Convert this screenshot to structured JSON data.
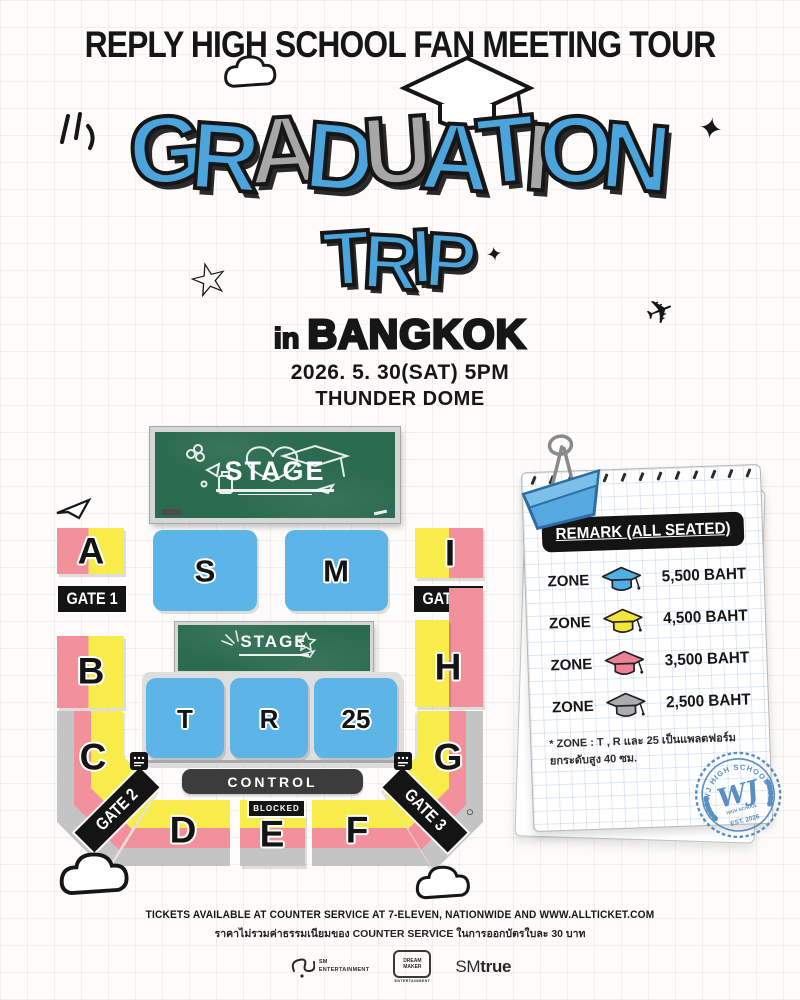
{
  "poster_title": "REPLY HIGH SCHOOL FAN MEETING TOUR",
  "hero": {
    "letters": [
      {
        "ch": "G",
        "color": "blue"
      },
      {
        "ch": "R",
        "color": "blue"
      },
      {
        "ch": "A",
        "color": "gray"
      },
      {
        "ch": "D",
        "color": "blue"
      },
      {
        "ch": "U",
        "color": "gray"
      },
      {
        "ch": "A",
        "color": "blue"
      },
      {
        "ch": "T",
        "color": "blue"
      },
      {
        "ch": "I",
        "color": "gray"
      },
      {
        "ch": "O",
        "color": "blue"
      },
      {
        "ch": "N",
        "color": "blue"
      }
    ],
    "line2": "TRIP",
    "location_prefix": "in",
    "location": "BANGKOK",
    "date_line": "2026. 5. 30(SAT) 5PM",
    "venue_line": "THUNDER DOME",
    "colors": {
      "blue": "#4BA5DC",
      "gray": "#A7A7A7"
    }
  },
  "map": {
    "stage_main_label": "STAGE",
    "stage_second_label": "STAGE",
    "zones": {
      "a": "A",
      "b": "B",
      "c": "C",
      "d": "D",
      "e": "E",
      "f": "F",
      "g": "G",
      "h": "H",
      "i": "I",
      "s": "S",
      "m": "M",
      "t": "T",
      "r": "R",
      "z25": "25"
    },
    "gates": {
      "g1": "GATE 1",
      "g2": "GATE 2",
      "g3": "GATE 3",
      "g4": "GATE 4"
    },
    "control_label": "CONTROL",
    "blocked_label": "BLOCKED"
  },
  "remark": {
    "header": "REMARK (ALL SEATED)",
    "rows": [
      {
        "label": "ZONE",
        "cap_color": "#4FAEE3",
        "price": "5,500 BAHT"
      },
      {
        "label": "ZONE",
        "cap_color": "#F2E63A",
        "price": "4,500 BAHT"
      },
      {
        "label": "ZONE",
        "cap_color": "#EE8193",
        "price": "3,500 BAHT"
      },
      {
        "label": "ZONE",
        "cap_color": "#ACACAC",
        "price": "2,500 BAHT"
      }
    ],
    "note_line1": "* ZONE : T , R และ 25 เป็นแพลตฟอร์ม",
    "note_line2": "ยกระดับสูง 40 ซม.",
    "badge": {
      "arc_text": "WJ HIGH SCHOOL",
      "monogram": "WJ",
      "sub_text": "HIGH SCHOOL",
      "est_text": "EST. 2026"
    }
  },
  "footer": {
    "tickets_line": "TICKETS AVAILABLE AT COUNTER SERVICE AT 7-ELEVEN, NATIONWIDE AND WWW.ALLTICKET.COM",
    "fee_line": "ราคาไม่รวมค่าธรรมเนียมของ COUNTER SERVICE ในการออกบัตรใบละ 30 บาท",
    "logos": {
      "sm_line1": "SM",
      "sm_line2": "ENTERTAINMENT",
      "dm_line1": "DREAM",
      "dm_line2": "MAKER",
      "dm_sub": "ENTERTAINMENT",
      "smtrue_sm": "SM",
      "smtrue_true": "true"
    }
  },
  "icons": {
    "star_outline": "☆",
    "sparkle": "✦",
    "airplane": "✈",
    "circle_doodle": "○"
  },
  "colors": {
    "pink": "#F2909B",
    "yellow": "#F7EC49",
    "zoneblue": "#5CB4E7",
    "bandgray": "#C4C4C4",
    "platform": "#DEDEDE",
    "green": "#2B6B4F",
    "ink": "#161616",
    "clipblue": "#55A9E0",
    "badgeblue": "#4E86BE"
  }
}
